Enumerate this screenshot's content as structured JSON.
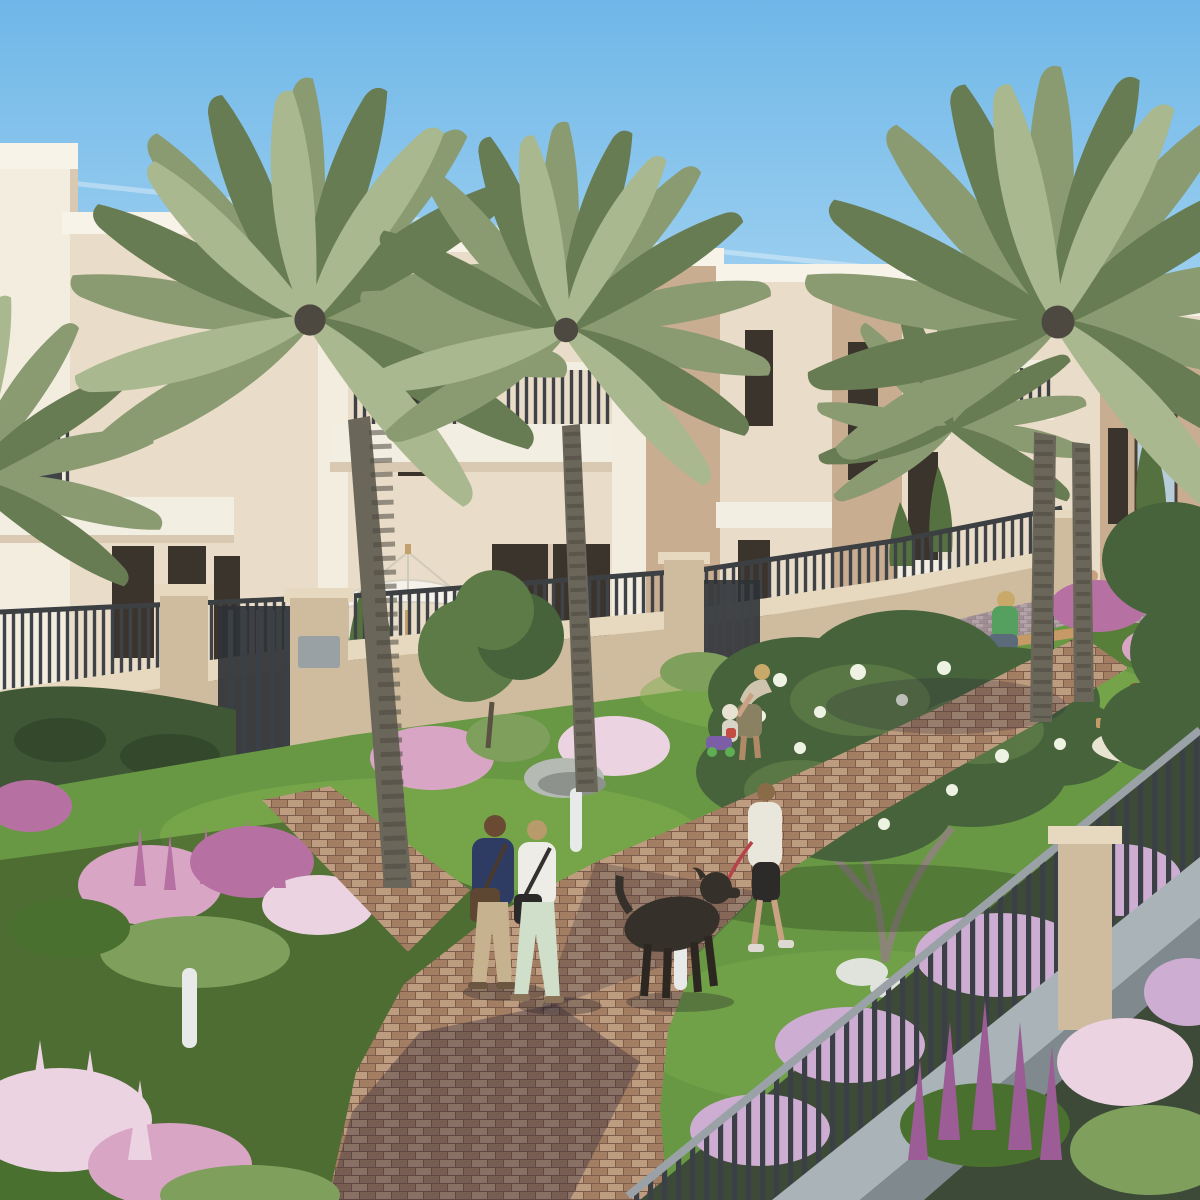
{
  "meta": {
    "kind": "architectural-rendering",
    "subject": "townhouse community courtyard with palm trees, garden path and residents",
    "time_of_day": "late afternoon sun from the right",
    "visible_text": "none"
  },
  "colors": {
    "sky_top": "#6fb7e8",
    "sky_mid": "#a9d6f2",
    "sky_horizon": "#e2f1fa",
    "contrail": "#ffffff",
    "bldg_cream": "#e9dcc8",
    "bldg_cream_light": "#f3ede0",
    "bldg_trim": "#f7f3e9",
    "bldg_tan": "#c9ad90",
    "bldg_tan_dark": "#b99b7e",
    "bldg_shade": "#d9c9b2",
    "window_dark": "#3b342c",
    "glass_sky": "#b7cdd9",
    "railing_dark": "#3f4347",
    "slab_white": "#f3eee2",
    "wall_cap": "#e6d9bf",
    "wall_body": "#cfbc9e",
    "wall_shade": "#b4a184",
    "gate_dark": "#34383b",
    "mailbox_gray": "#9aa1a5",
    "umbrella_white": "#f4f2ea",
    "umbrella_pole": "#c2a06c",
    "bbq_steel": "#b9bec2",
    "cypress": "#55713f",
    "hedge": "#3f5734",
    "tree_green": "#5d7b47",
    "tree_dark": "#46633c",
    "blossom_white": "#eef2e2",
    "branch_gray": "#8b8578",
    "palm_frond": "#8a9b72",
    "palm_frond_dark": "#687c53",
    "palm_frond_light": "#a9b88e",
    "palm_trunk": "#6b665a",
    "palm_trunk_dark": "#4d4940",
    "grass_sun": "#7fae4f",
    "grass_mid": "#699844",
    "grass_shade": "#4a7030",
    "path_light": "#bd9c7f",
    "path_mid": "#a37e63",
    "path_dark": "#7c5c4a",
    "flower_pink": "#d8a5c5",
    "flower_pink_light": "#ecd3e2",
    "flower_magenta": "#b671a2",
    "flower_purple": "#9c5d96",
    "flower_lilac": "#cdaed2",
    "plant_green": "#7fa05c",
    "rock_gray": "#b5bab4",
    "rock_shade": "#8d928c",
    "stone_white": "#dfe3dc",
    "fence_dark": "#3a4046",
    "fence_rail": "#9aa2a8",
    "fence_base": "#aab3b7",
    "fence_base_dark": "#7f898e",
    "bench_wood": "#c59a66",
    "beam_wood": "#d7ae62",
    "bollard_white": "#e8eae9",
    "bollard_pole_dark": "#3a3a3a",
    "skin": "#c99f80"
  },
  "scene": {
    "sky": {
      "description": "clear light blue sky, faint diagonal contrails"
    },
    "buildings": {
      "description": "row of two-storey flat-roofed cream and tan townhouses receding to the right, dark framed windows, white parapet trims, balconies with dark metal railings",
      "count_visible": 6
    },
    "boundary_wall": {
      "description": "beige stucco garden wall topped with dark vertical-bar railing, pillars, two dark entry gates, gray mailboxes"
    },
    "garden": {
      "description": "lawn with pink, magenta and lilac flowering shrubs, conical cypresses, white-blossom frangipani tree, gray boulder, white bollard lights"
    },
    "paths": {
      "description": "curving red-brown brick paver walkways crossing the lawn, distant gray paver loop path"
    },
    "people": [
      {
        "id": "man-walking",
        "shirt": "#2e3c64",
        "pants": "#c7b28f",
        "bag": "#5d4632",
        "hair": "#6b4a33"
      },
      {
        "id": "woman-walking",
        "shirt": "#edece6",
        "pants": "#cfdfca",
        "bag": "#2b292a",
        "hair": "#b99a6a"
      },
      {
        "id": "dog-walker",
        "top": "#e9e6dc",
        "leggings": "#2c2b2a",
        "leash": "#b5434a",
        "hair": "#8a6b48"
      },
      {
        "id": "parent-with-toddler",
        "top": "#cfc5ae",
        "pants": "#8a8163",
        "hair": "#c9a96a"
      },
      {
        "id": "toddler",
        "hat": "#e8e2d2",
        "top": "#d9d4c8"
      },
      {
        "id": "bench-sitter",
        "shirt": "#55a05e",
        "pants": "#5c6b7a",
        "hair": "#c9a96a"
      },
      {
        "id": "picnic-person-blue",
        "dress": "#7e8fc0",
        "hair": "#7a4f33"
      },
      {
        "id": "picnic-person-white",
        "shirt": "#edece6",
        "cap": "#d8d2c6"
      },
      {
        "id": "distant-walker-dress",
        "dress": "#b9b08e",
        "bag": "#d9833f",
        "hair": "#3f352c"
      },
      {
        "id": "distant-walker-child",
        "top": "#e8e6de",
        "shorts": "#4a463f"
      },
      {
        "id": "distant-walker-teen",
        "top": "#efece4",
        "shorts": "#cbb693",
        "hair": "#3f352c"
      }
    ],
    "animals": [
      {
        "id": "dog",
        "type": "dark curly-haired dog on red leash",
        "color": "#36302a"
      }
    ],
    "props": {
      "toy": {
        "body": "#7b5ea6",
        "accent": "#c24b42",
        "wheel": "#5fae54"
      },
      "blanket": "#e9e3d2",
      "bench": "wooden garden bench",
      "umbrella": "white patio umbrella behind wall",
      "bbq": "stainless grill behind wall"
    }
  }
}
